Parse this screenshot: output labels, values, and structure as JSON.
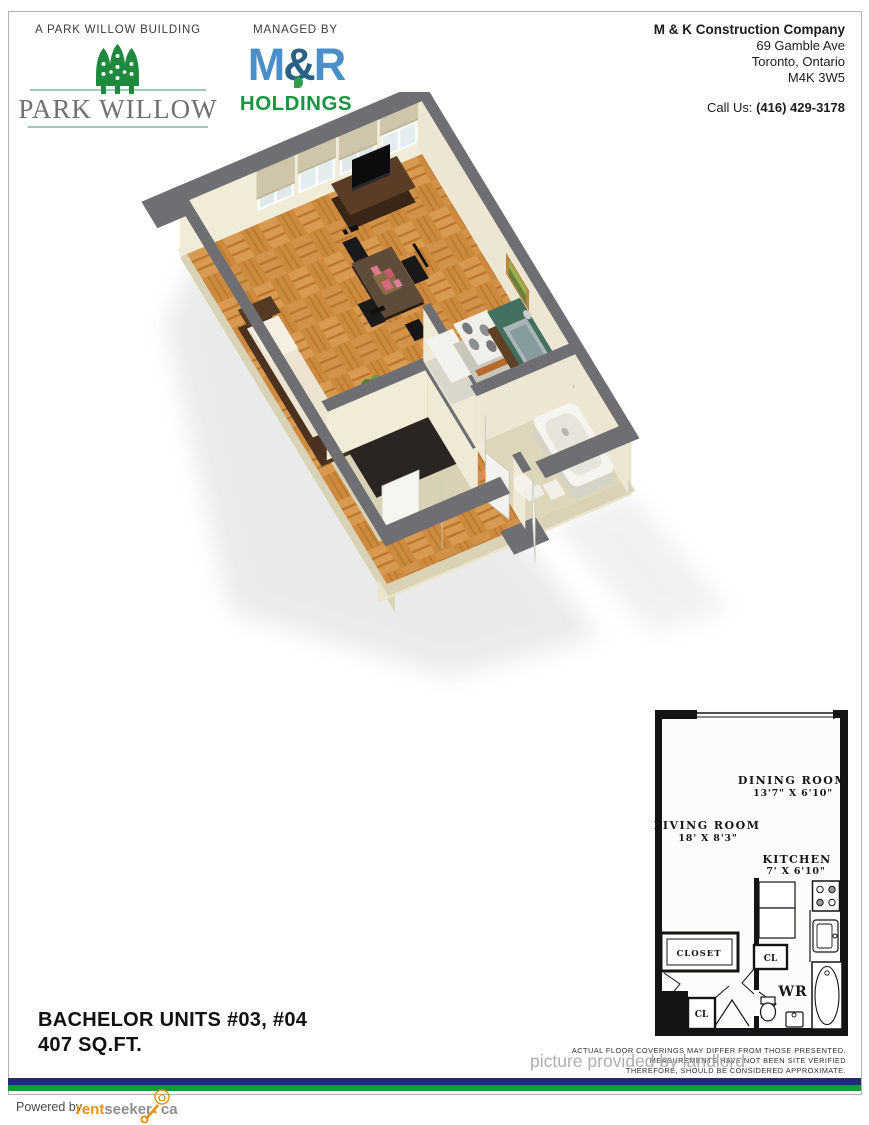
{
  "header": {
    "building_label": "A PARK WILLOW BUILDING",
    "brand_name": "PARK WILLOW",
    "managed_by_label": "MANAGED BY",
    "manager": {
      "m": "M",
      "amp": "&",
      "r": "R",
      "holdings": "HOLDINGS"
    },
    "contact": {
      "company": "M & K Construction Company",
      "address_line1": "69 Gamble Ave",
      "address_line2": "Toronto, Ontario",
      "postal_code": "M4K 3W5",
      "call_us_label": "Call Us:",
      "phone": "(416) 429-3178"
    }
  },
  "unit": {
    "title": "BACHELOR UNITS #03, #04",
    "size": "407 SQ.FT."
  },
  "plan2d": {
    "rooms": {
      "dining": {
        "name": "DINING ROOM",
        "dims": "13'7\" X 6'10\""
      },
      "living": {
        "name": "LIVING ROOM",
        "dims": "18' X 8'3\""
      },
      "kitchen": {
        "name": "KITCHEN",
        "dims": "7' X 6'10\""
      },
      "closet": {
        "name": "CLOSET"
      },
      "wr": {
        "name": "WR"
      },
      "cl1": {
        "name": "CL"
      },
      "cl2": {
        "name": "CL"
      }
    },
    "disclaimer": [
      "ACTUAL FLOOR COVERINGS MAY DIFFER FROM THOSE PRESENTED.",
      "MEASUREMENTS HAVE NOT BEEN SITE VERIFIED",
      "THEREFORE, SHOULD BE CONSIDERED APPROXIMATE."
    ]
  },
  "watermark": "picture provided by landlord",
  "footer": {
    "powered_by": "Powered by",
    "logo": {
      "rent": "rent",
      "seeker": "seeker",
      "ca": "ca"
    }
  },
  "colors": {
    "park_willow_green": "#1f8a3d",
    "wordmark_gray": "#717173",
    "teal_line": "#9dc9bd",
    "mr_blue": "#4a8fc7",
    "mr_amp_blue": "#2a6286",
    "holdings_green": "#17953f",
    "stripe_navy": "#1f2c6e",
    "stripe_green": "#169a38",
    "rentseeker_orange": "#ea9210",
    "wall_cap_gray": "#6f6e73",
    "wall_cream": "#f1ecd8",
    "floor_parquet": "#cd8a3e"
  }
}
